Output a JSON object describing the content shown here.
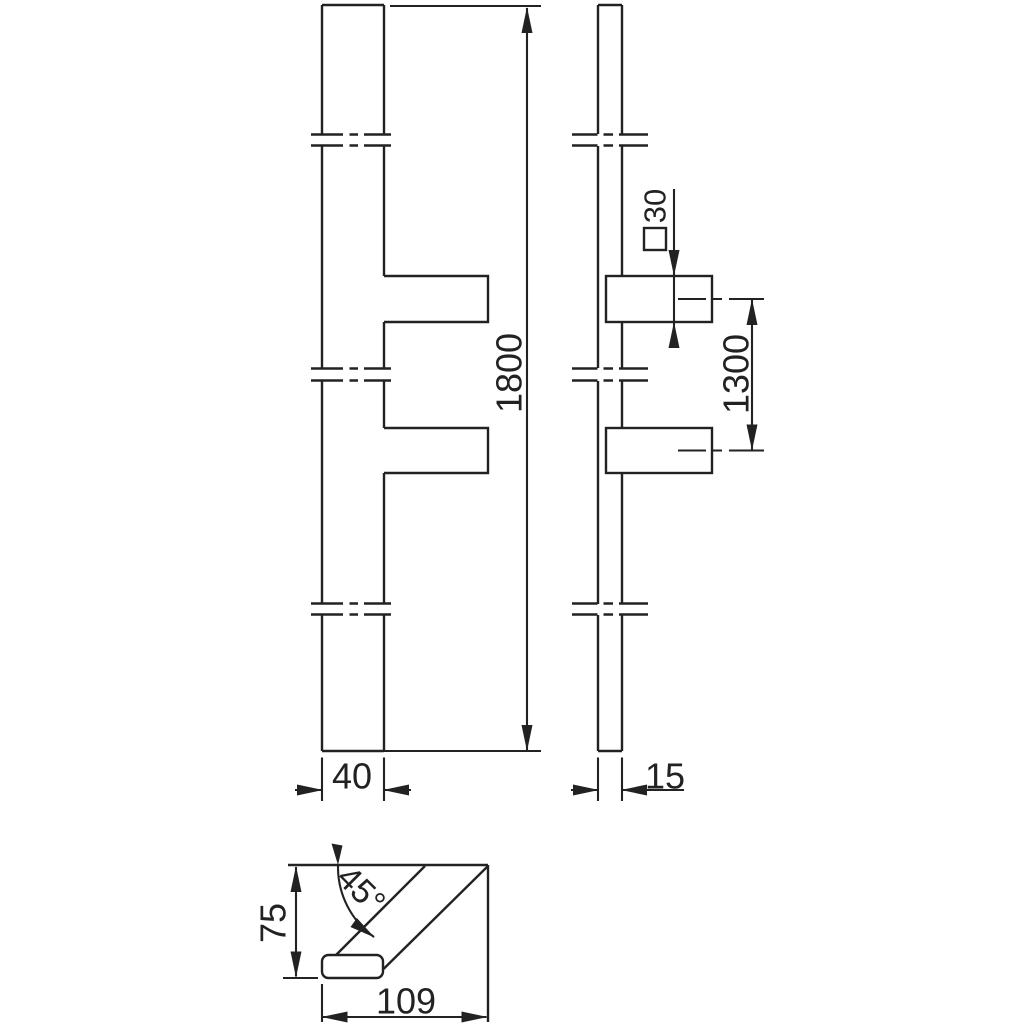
{
  "drawing": {
    "kind": "technical-drawing-door-pull-handle",
    "dims": {
      "total_length": "1800",
      "fixing_centers": "1300",
      "stud_section": "30",
      "grip_width": "40",
      "grip_depth": "15",
      "section_height": "75",
      "section_width": "109",
      "section_angle": "45°"
    },
    "symbols": {
      "square_section": "□"
    },
    "colors": {
      "line": "#222222",
      "background": "#ffffff"
    }
  }
}
